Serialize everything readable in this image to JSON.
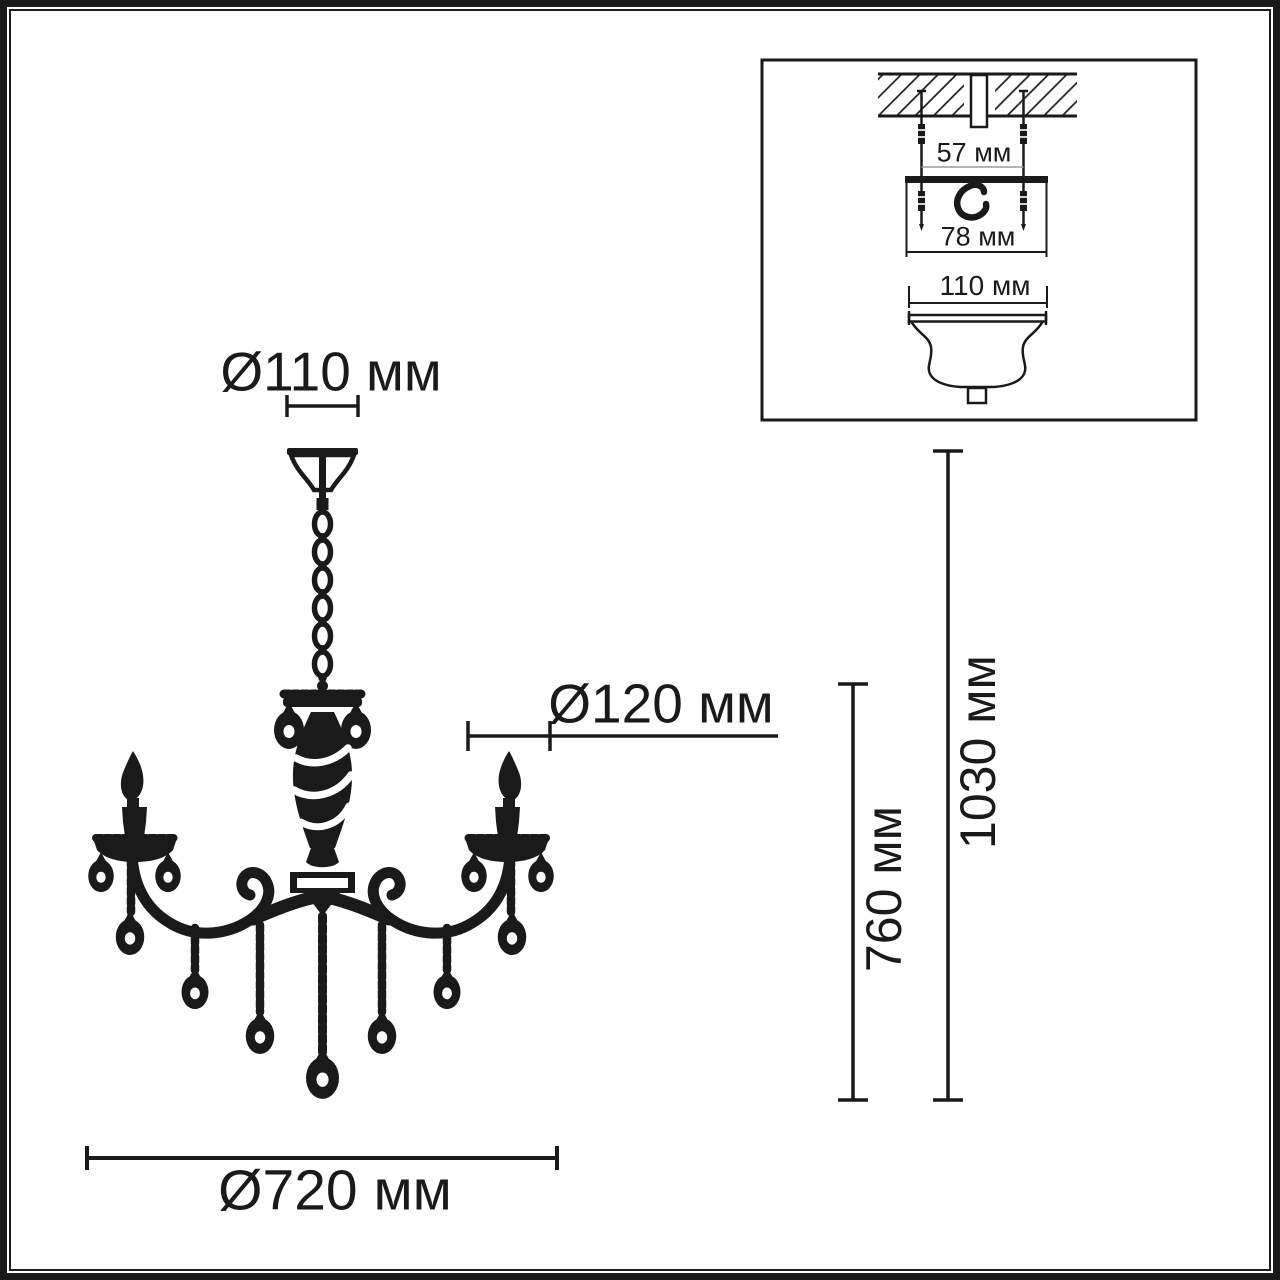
{
  "drawing": {
    "background": "#ffffff",
    "ink_color": "#1a1a1a",
    "hatch_color": "#1a1a1a",
    "extension_line_color": "#9a9a9a",
    "main_dimensions": {
      "canopy_diameter": "Ø110 мм",
      "arm_socket_diameter": "Ø120 мм",
      "overall_diameter": "Ø720 мм",
      "body_height": "760 мм",
      "total_height": "1030 мм"
    },
    "mount_inset": {
      "screw_spacing": "57 мм",
      "mount_plate_width": "78 мм",
      "canopy_cup_diameter": "110 мм"
    }
  }
}
